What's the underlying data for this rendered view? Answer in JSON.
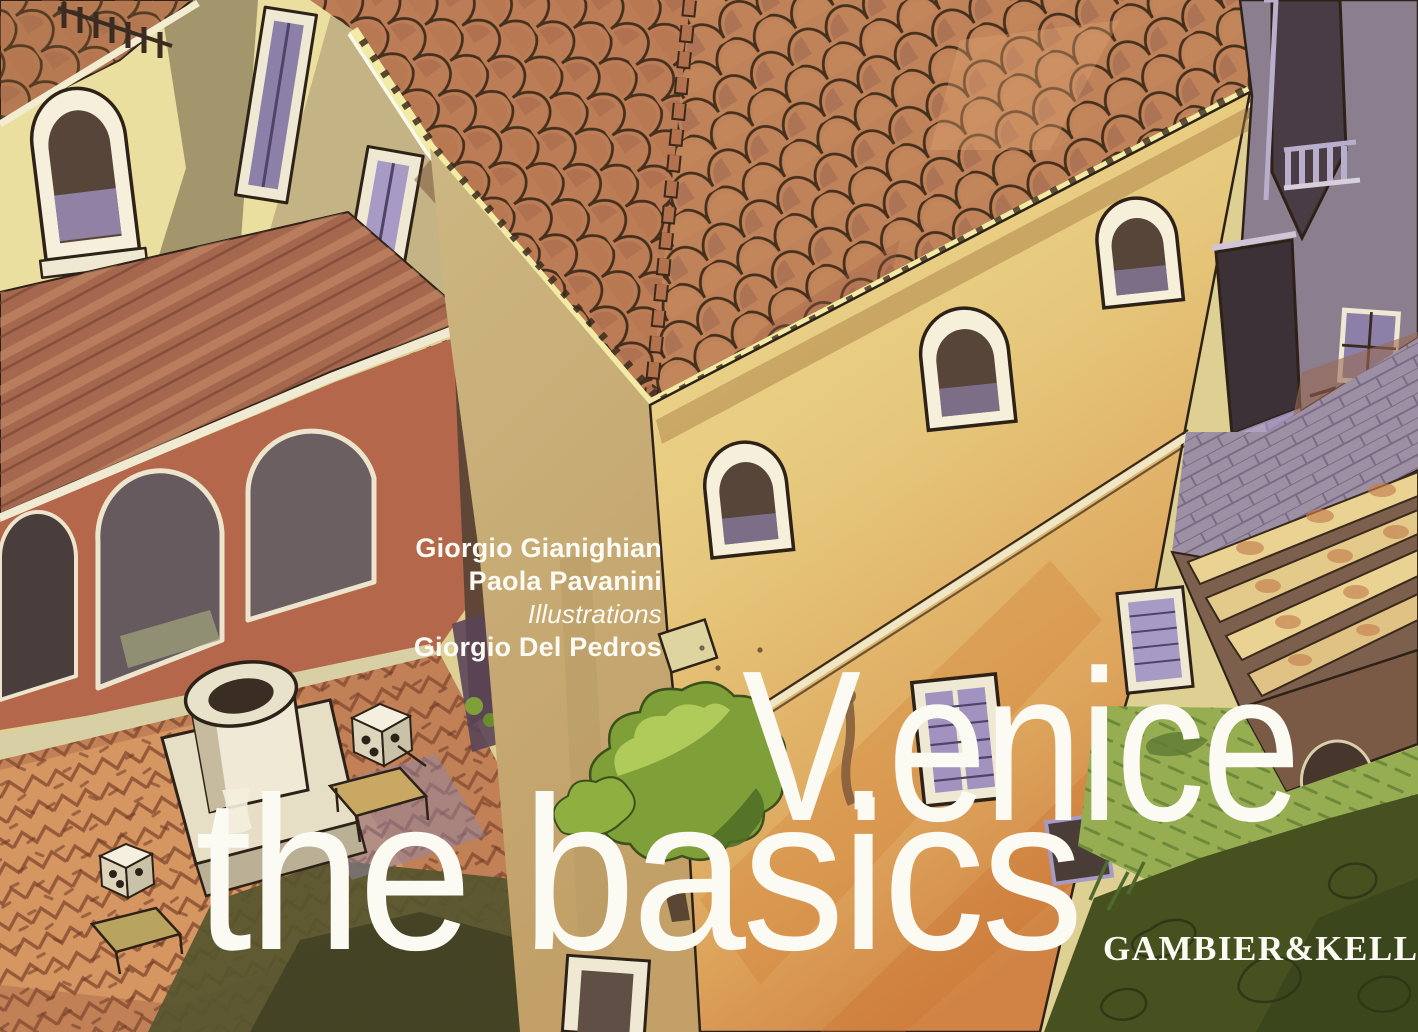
{
  "cover": {
    "authors": [
      "Giorgio Gianighian",
      "Paola Pavanini"
    ],
    "illustrations_label": "Illustrations",
    "illustrator": "Giorgio Del Pedros",
    "title": {
      "line1": "V.enice",
      "line2": "the basics"
    },
    "publisher": "GAMBIER&KELLER",
    "illustration_alt": "Watercolor aerial view of a Venetian courtyard: terracotta hipped roof, ochre house with arched windows, loggia with arches, stone wellhead, small tree and dark green canal water"
  },
  "palette": {
    "text_white": "#fbfaf3",
    "wall_cream": "#ebdf9f",
    "wall_shadow": "#a3966c",
    "wall_yellow": "#e6cd80",
    "wall_orange": "#d08344",
    "roof_terracotta": "#bc7d56",
    "roof_deep": "#9a5a42",
    "fascia_cream": "#f2eba6",
    "loggia_red": "#b4674a",
    "shutter_lavender": "#a79ac4",
    "stone_grey": "#8b7e8e",
    "pavement_brick": "#c28056",
    "shadow_olive": "#55552f",
    "grass_green": "#96ad52",
    "water_green": "#46511f",
    "ink": "#2e2218"
  }
}
